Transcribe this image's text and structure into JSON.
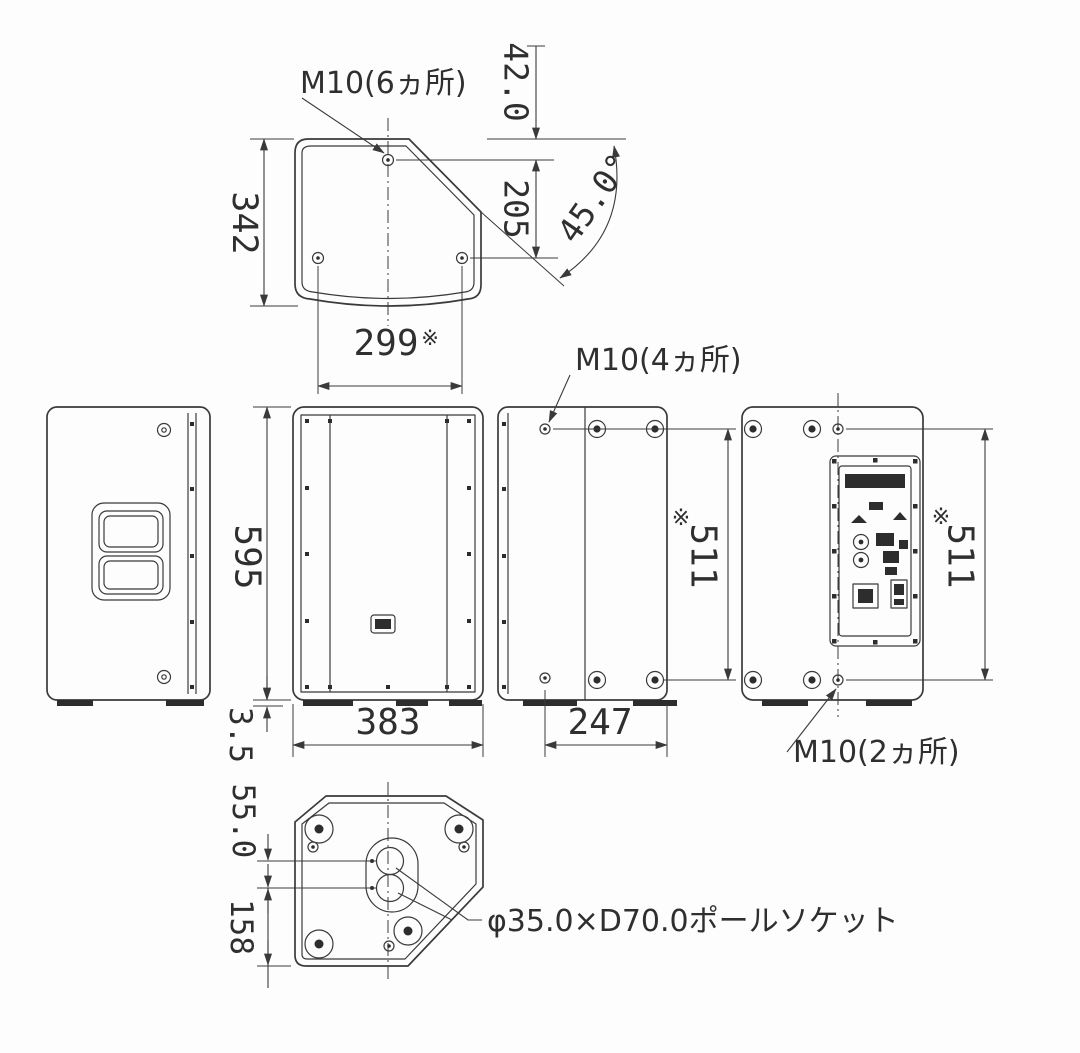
{
  "drawing": {
    "kind": "speaker-cabinet-dimension-diagram",
    "background_color": "#fdfdfd",
    "line_color": "#3a3a3a"
  },
  "labels": {
    "m10_6_holes": "M10(6ヵ所)",
    "m10_4_holes": "M10(4ヵ所)",
    "m10_2_holes": "M10(2ヵ所)",
    "pole_socket": "φ35.0×D70.0ポールソケット",
    "ref_mark": "※"
  },
  "dims": {
    "top_depth": "342",
    "top_hole_span": "299",
    "top_hole_offset": "42.0",
    "top_hole_pitch": "205",
    "baffle_angle": "45.0°",
    "cabinet_height": "595",
    "foot_height": "3.5",
    "cabinet_width": "383",
    "side_hole_to_back": "247",
    "side_hole_pitch": "511",
    "rear_hole_pitch": "511",
    "socket_pitch": "55.0",
    "socket_to_back": "158"
  }
}
